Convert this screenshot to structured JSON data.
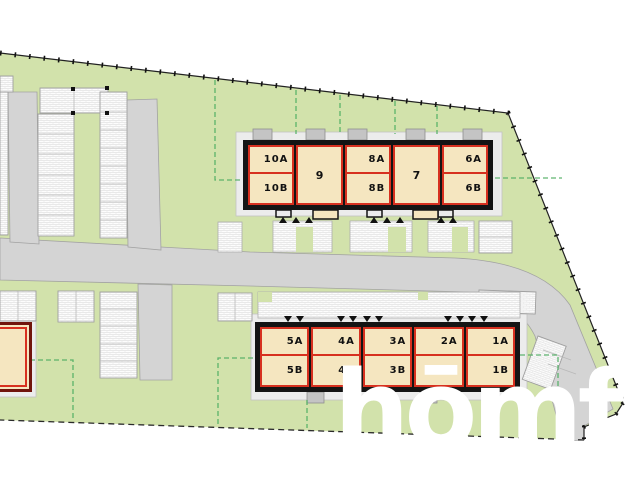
{
  "plan": {
    "watermark": "hōmfi",
    "buildings": {
      "north_row": {
        "units": [
          {
            "type": "duplex",
            "label_a": "10A",
            "label_b": "10B"
          },
          {
            "type": "single",
            "label": "9"
          },
          {
            "type": "duplex",
            "label_a": "8A",
            "label_b": "8B"
          },
          {
            "type": "single",
            "label": "7"
          },
          {
            "type": "duplex",
            "label_a": "6A",
            "label_b": "6B"
          }
        ]
      },
      "south_row": {
        "units": [
          {
            "type": "duplex",
            "label_a": "5A",
            "label_b": "5B"
          },
          {
            "type": "duplex",
            "label_a": "4A",
            "label_b": "4B"
          },
          {
            "type": "duplex",
            "label_a": "3A",
            "label_b": "3B"
          },
          {
            "type": "duplex",
            "label_a": "2A",
            "label_b": "2B"
          },
          {
            "type": "duplex",
            "label_a": "1A",
            "label_b": "1B"
          }
        ]
      }
    },
    "colors": {
      "site_green": "#d2e2ab",
      "building_fill": "#f5e6c0",
      "unit_border_red": "#d7301f",
      "building_outline_black": "#141414",
      "west_building_border": "#71140c",
      "road_gray": "#d4d4d4",
      "sidewalk_gray": "#ececec",
      "parking_white": "#fdfdfd",
      "plot_dash_green": "#4fae63",
      "boundary_black": "#1a1a1a",
      "watermark_white": "#ffffff"
    }
  }
}
